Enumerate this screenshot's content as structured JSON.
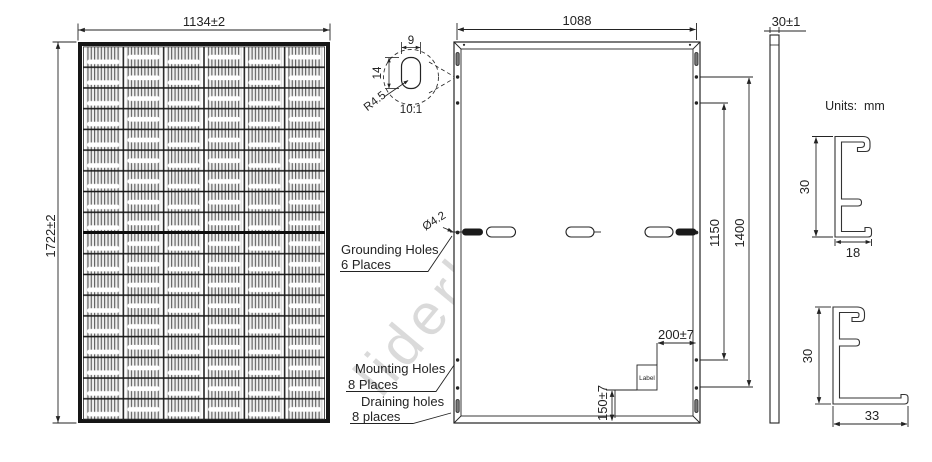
{
  "watermark": "liderlamp.pl",
  "units_label": "Units:  mm",
  "front_view": {
    "width_dim": "1134±2",
    "height_dim": "1722±2",
    "grid": {
      "columns": 6,
      "rows": 18
    }
  },
  "back_view": {
    "width_dim": "1088",
    "detail": {
      "slot_width": "9",
      "slot_height": "14",
      "radius": "R4.5",
      "scale": "10:1"
    },
    "grounding_dia": "Ø4.2",
    "grounding_line1": "Grounding Holes",
    "grounding_line2": "6 Places",
    "mounting_line1": "Mounting Holes",
    "mounting_line2": "8 Places",
    "draining_line1": "Draining holes",
    "draining_line2": "8 places",
    "dim_inner_holes": "1150",
    "dim_outer_holes": "1400",
    "dim_label_x": "200±7",
    "dim_label_y": "150±7",
    "label_box": "Label"
  },
  "side_view": {
    "thickness_dim": "30±1"
  },
  "profiles": {
    "top": {
      "height_dim": "30",
      "foot_dim": "18"
    },
    "bottom": {
      "height_dim": "30",
      "foot_dim": "33"
    }
  },
  "colors": {
    "line": "#232323",
    "cell_finger": "#4a4a4a",
    "cell_bg": "#efefef",
    "watermark": "#000000"
  }
}
